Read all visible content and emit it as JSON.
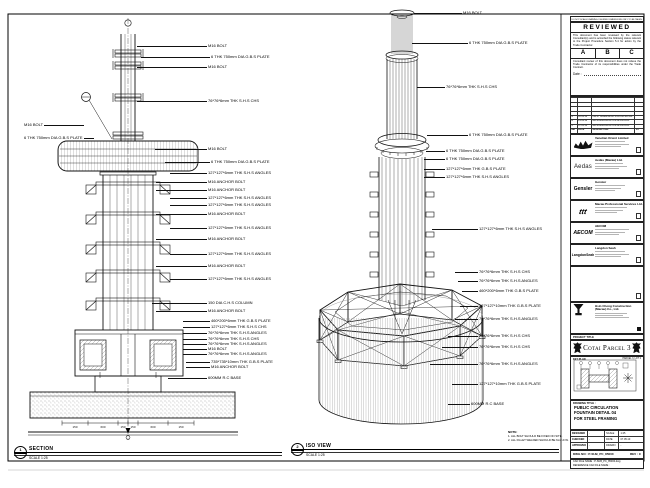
{
  "section_view": {
    "bubble_no": "1",
    "bubble_ref": "-",
    "title": "SECTION",
    "scale": "SCALE 1:25",
    "left_callouts": [
      "M16 BOLT",
      "6 THK 750mm DIA G.B.S PLATE"
    ],
    "callouts": [
      "M16 BOLT",
      "6 THK 750mm DIA G.B.S PLATE",
      "M16 BOLT",
      "76*76*6mm THK S.H.S CHS",
      "M16 BOLT",
      "6 THK 750mm DIA G.B.S PLATE",
      "127*127*6mm THK S.H.S ANGLES",
      "M16 ANCHOR BOLT",
      "M16 ANCHOR BOLT",
      "127*127*6mm THK S.H.S ANGLES",
      "127*127*6mm THK S.H.S ANGLES",
      "M16 ANCHOR BOLT",
      "127*127*6mm THK S.H.S ANGLES",
      "M16 ANCHOR BOLT",
      "127*127*6mm THK S.H.S ANGLES",
      "M16 ANCHOR BOLT",
      "127*127*6mm THK S.H.S ANGLES",
      "150 DIA C.H.S COLUMN",
      "M16 ANCHOR BOLT",
      "460*200*6mm THK G.B.S PLATE",
      "127*127*6mm THK S.H.S CHS",
      "76*76*6mm THK S.H.S ANGLES",
      "76*76*6mm THK S.H.S CHS",
      "76*76*6mm THK S.H.S ANGLES",
      "M16 BOLT",
      "76*76*6mm THK S.H.S ANGLES",
      "735*735*10mm THK G.B.S PLATE",
      "M16 ANCHOR BOLT",
      "600MM R.C BASE"
    ],
    "dimensions": [
      "150",
      "600",
      "150",
      "150",
      "600",
      "150"
    ]
  },
  "iso_view": {
    "bubble_no": "2",
    "bubble_ref": "-",
    "title": "ISO VIEW",
    "scale": "SCALE 1:25",
    "callouts": [
      "M16 BOLT",
      "6 THK 750mm DIA G.B.S PLATE",
      "76*76*6mm THK S.H.S CHS",
      "6 THK 750mm DIA G.B.S PLATE",
      "6 THK 750mm DIA G.B.S PLATE",
      "6 THK 750mm DIA G.B.S PLATE",
      "127*127*6mm THK G.B.S PLATE",
      "127*127*6mm THK S.H.S ANGLES",
      "127*127*6mm THK S.H.S ANGLES",
      "76*76*6mm THK S.H.S CHS",
      "76*76*6mm THK S.H.S ANGLES",
      "460*200*6mm THK G.B.S PLATE",
      "127*127*10mm THK G.B.S PLATE",
      "76*76*6mm THK S.H.S ANGLES",
      "76*76*6mm THK S.H.S CHS",
      "76*76*6mm THK S.H.S CHS",
      "76*76*6mm THK S.H.S ANGLES",
      "127*127*10mm THK G.B.S PLATE",
      "600MM R.C BASE"
    ],
    "note_title": "NOTE:",
    "notes": [
      "1. ALL BOLT SHOULD BE FIXED ON SITE.",
      "2. ALL FILLET WELDED SHOULD BE 6mm F.W."
    ]
  },
  "title_block": {
    "strip": "DO NOT SCALE DRAWING. FIGURED DIMENSIONS ONLY TO BE TAKEN.",
    "reviewed": {
      "title": "REVIEWED",
      "para1": "This document has been reviewed by the relevant Consultant(s) and is accorded the following status relevant to the Project Procedure Section 5.4 for action by the Trade Contractor.",
      "options": [
        "A",
        "B",
        "C"
      ],
      "para2": "Consultant review of this document does not relieve the Trade Contractor of its responsibilities under the Trade Contract.",
      "date_label": "Date :"
    },
    "revisions": {
      "header": {
        "mk": "MK",
        "date": "DATE",
        "desc": "DESCRIPTION",
        "by": "BY"
      },
      "rows": [
        {
          "mk": "A",
          "date": "12.03.10",
          "desc": "FIRST SUBMISSION FOR APPROVAL",
          "by": ""
        },
        {
          "mk": "B",
          "date": "21.04.10",
          "desc": "RE-SUBMISSION FOR APPROVAL",
          "by": ""
        },
        {
          "mk": "C",
          "date": "07.05.10",
          "desc": "RE-SUBMISSION FOR APPROVAL",
          "by": ""
        }
      ]
    },
    "consultants": [
      {
        "logo": "",
        "name": "Venetian Orient Limited"
      },
      {
        "logo": "Aedas",
        "name": "Aedas (Macau) Ltd."
      },
      {
        "logo": "Gensler",
        "name": "Gensler"
      },
      {
        "logo": "ttt",
        "name": "Macau Professional Services Ltd."
      },
      {
        "logo": "AECOM",
        "name": "AECOM"
      },
      {
        "logo": "LangdonSeah",
        "name": "Langdon Seah"
      }
    ],
    "contractor": {
      "name": "Hsin Chong Construction (Macau) Co., Ltd."
    },
    "project": {
      "label": "PROJECT TITLE",
      "title": "Cotai Parcel 3"
    },
    "key_plan": {
      "label": "KEY PLAN",
      "zone": "PARCEL 3, LOT 2"
    },
    "drawing_title": {
      "label": "DRAWING TITLE :",
      "lines": [
        "PUBLIC CIRCULATION",
        "FOUNTAIN DETAIL 04",
        "FOR STEEL FRAMING"
      ]
    },
    "signoff": [
      {
        "k1": "DESIGNED",
        "v1": "-",
        "k2": "SCALE",
        "v2": "1:25"
      },
      {
        "k1": "CHECKED",
        "v1": "-",
        "k2": "DATE",
        "v2": "07.05.10"
      },
      {
        "k1": "APPROVED",
        "v1": "-",
        "k2": "DRAWN",
        "v2": "-"
      }
    ],
    "dwg": {
      "label": "DWG NO :",
      "value": "P-SUB_PC_85000",
      "rev": "REV : C"
    },
    "cad": {
      "line1": "CAD FILE NAME : P-SUB_PC_85000.dwg",
      "line2": "REFERENCE CAD FILE NAME :"
    }
  }
}
